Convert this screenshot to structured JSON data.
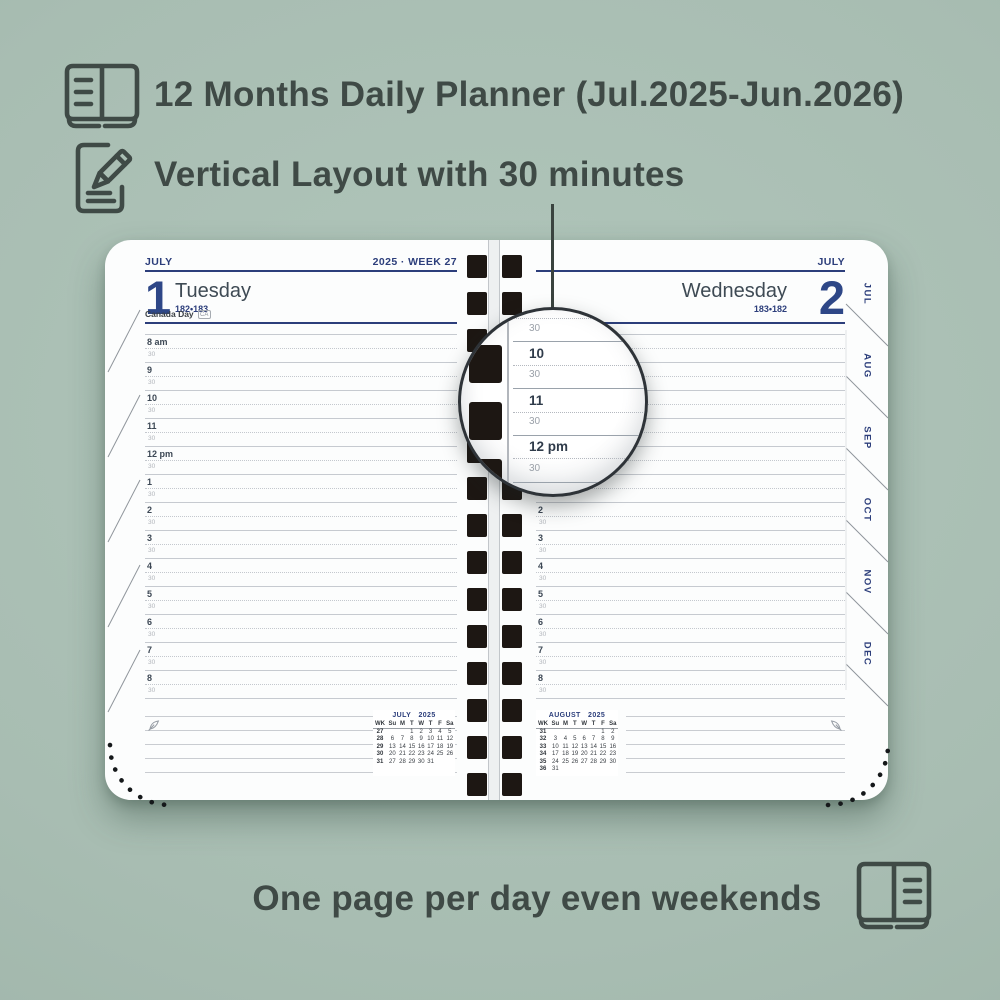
{
  "colors": {
    "background": "#a9beb3",
    "ink": "#3f4a46",
    "navy": "#2c3e7b",
    "number_blue": "#2e4787",
    "grid_line": "#c8ccd1",
    "spiral_hole": "#1d1713"
  },
  "features": [
    {
      "icon": "open-book-icon",
      "label": "12 Months Daily Planner (Jul.2025-Jun.2026)"
    },
    {
      "icon": "pencil-note-icon",
      "label": "Vertical Layout with 30 minutes"
    }
  ],
  "footer": {
    "icon": "open-book-lines-icon",
    "label": "One page per day even weekends"
  },
  "planner": {
    "left_page": {
      "month": "JULY",
      "week_label": "2025 · WEEK 27",
      "day_number": "1",
      "weekday": "Tuesday",
      "day_of_year": "182•183",
      "holiday": "Canada Day",
      "holiday_badge": "CA"
    },
    "right_page": {
      "month": "JULY",
      "day_number": "2",
      "weekday": "Wednesday",
      "day_of_year": "183•182"
    },
    "schedule": {
      "hours": [
        "8 am",
        "9",
        "10",
        "11",
        "12 pm",
        "1",
        "2",
        "3",
        "4",
        "5",
        "6",
        "7",
        "8"
      ],
      "half_label": "30"
    },
    "month_tabs": [
      "JUL",
      "AUG",
      "SEP",
      "OCT",
      "NOV",
      "DEC"
    ],
    "calendars": [
      {
        "title": "JULY 2025",
        "headers": [
          "WK",
          "Su",
          "M",
          "T",
          "W",
          "T",
          "F",
          "Sa"
        ],
        "rows": [
          [
            "27",
            "",
            "",
            "1",
            "2",
            "3",
            "4",
            "5"
          ],
          [
            "28",
            "6",
            "7",
            "8",
            "9",
            "10",
            "11",
            "12"
          ],
          [
            "29",
            "13",
            "14",
            "15",
            "16",
            "17",
            "18",
            "19"
          ],
          [
            "30",
            "20",
            "21",
            "22",
            "23",
            "24",
            "25",
            "26"
          ],
          [
            "31",
            "27",
            "28",
            "29",
            "30",
            "31",
            "",
            ""
          ]
        ]
      },
      {
        "title": "AUGUST 2025",
        "headers": [
          "WK",
          "Su",
          "M",
          "T",
          "W",
          "T",
          "F",
          "Sa"
        ],
        "rows": [
          [
            "31",
            "",
            "",
            "",
            "",
            "",
            "1",
            "2"
          ],
          [
            "32",
            "3",
            "4",
            "5",
            "6",
            "7",
            "8",
            "9"
          ],
          [
            "33",
            "10",
            "11",
            "12",
            "13",
            "14",
            "15",
            "16"
          ],
          [
            "34",
            "17",
            "18",
            "19",
            "20",
            "21",
            "22",
            "23"
          ],
          [
            "35",
            "24",
            "25",
            "26",
            "27",
            "28",
            "29",
            "30"
          ],
          [
            "36",
            "31",
            "",
            "",
            "",
            "",
            "",
            ""
          ]
        ]
      }
    ]
  },
  "magnifier": {
    "rows": [
      {
        "label": "30",
        "type": "half"
      },
      {
        "label": "10",
        "type": "hour"
      },
      {
        "label": "30",
        "type": "half"
      },
      {
        "label": "11",
        "type": "hour"
      },
      {
        "label": "30",
        "type": "half"
      },
      {
        "label": "12 pm",
        "type": "hour"
      },
      {
        "label": "30",
        "type": "half"
      }
    ]
  }
}
